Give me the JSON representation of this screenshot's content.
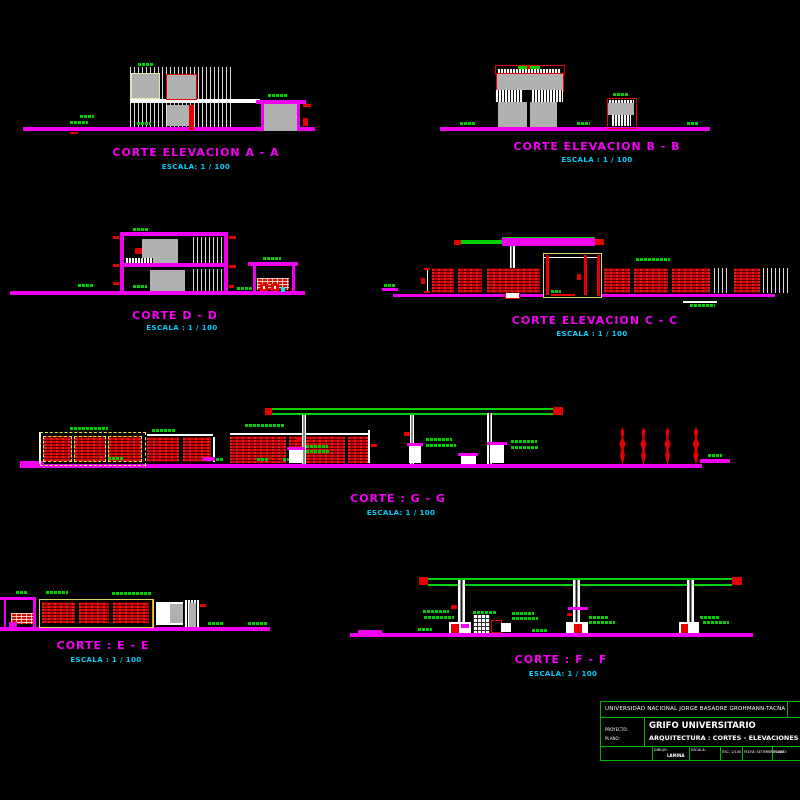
{
  "sheet": {
    "background": "#000000",
    "drawing_type": "architectural sections and elevations of a university gas station"
  },
  "drawings": [
    {
      "id": "A-A",
      "title": "CORTE ELEVACION  A - A",
      "scale": "ESCALA: 1 / 100"
    },
    {
      "id": "B-B",
      "title": "CORTE ELEVACION  B - B",
      "scale": "ESCALA : 1 / 100"
    },
    {
      "id": "D-D",
      "title": "CORTE  D - D",
      "scale": "ESCALA : 1 / 100"
    },
    {
      "id": "C-C",
      "title": "CORTE  ELEVACION C - C",
      "scale": "ESCALA : 1 / 100"
    },
    {
      "id": "G-G",
      "title": "CORTE : G - G",
      "scale": "ESCALA: 1 / 100"
    },
    {
      "id": "E-E",
      "title": "CORTE : E - E",
      "scale": "ESCALA : 1 / 100"
    },
    {
      "id": "F-F",
      "title": "CORTE : F - F",
      "scale": "ESCALA: 1 / 100"
    }
  ],
  "title_block": {
    "university": "UNIVERSIDAD NACIONAL JORGE BASADRE GROHMANN-TACNA",
    "project_label": "PROYECTO:",
    "project_value": "GRIFO UNIVERSITARIO",
    "plan_label": "PLANO:",
    "plan_value": "ARQUITECTURA : CORTES - ELEVACIONES",
    "cells": {
      "c2a": "DIBUJO:",
      "c2b": "LAMINA",
      "c3": "ESCALA:",
      "c4": "ESC: 1/100",
      "c5": "FECHA: SETIEMBRE-2007",
      "c6": "PLANO:"
    }
  },
  "colors": {
    "magenta": "#f000f0",
    "red": "#e60000",
    "green": "#00cf00",
    "cyan_text": "#00cfff",
    "gray_fill": "#b0b0b0",
    "yellow": "#e8e86a",
    "white": "#ffffff",
    "title_block_green": "#00b400"
  }
}
